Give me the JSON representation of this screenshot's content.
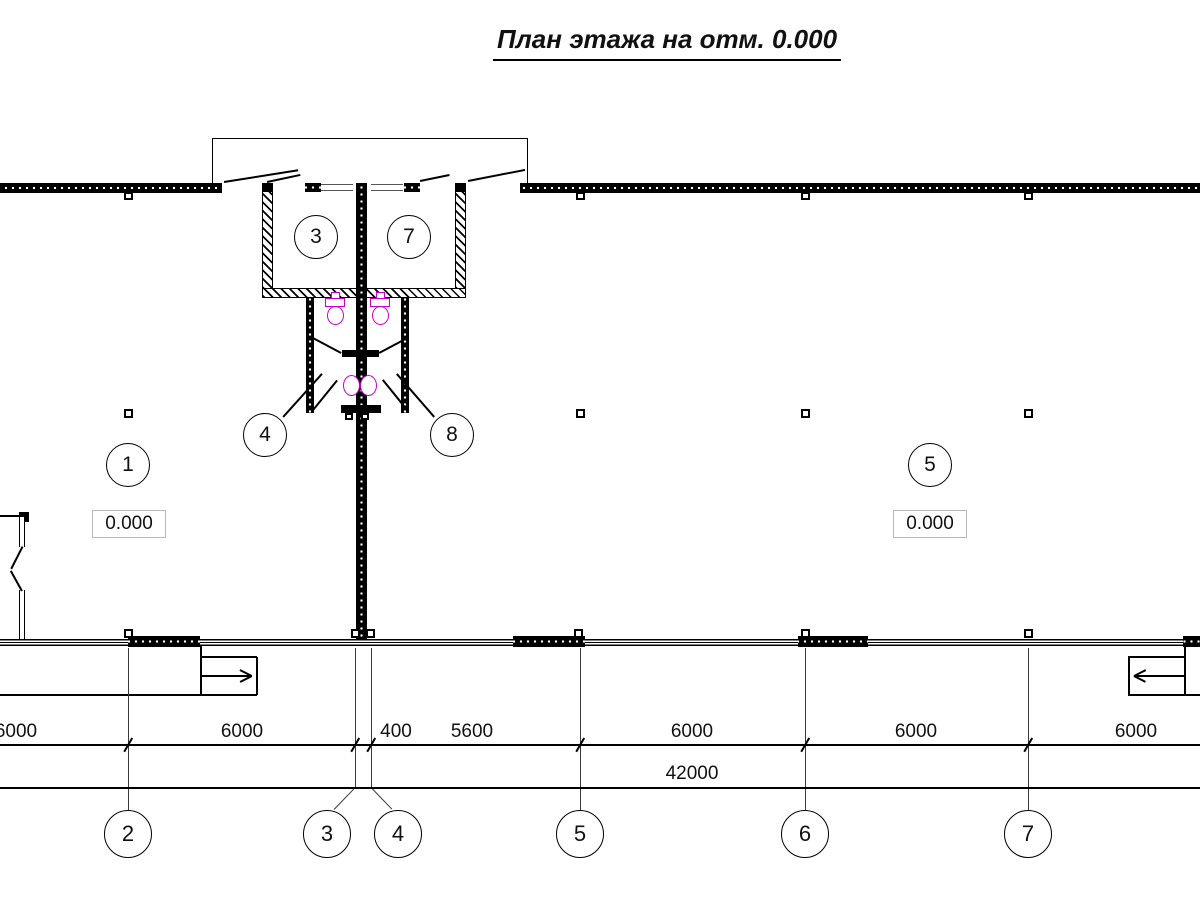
{
  "title": "План этажа на отм. 0.000",
  "colors": {
    "fixture_magenta": "#CC00CC",
    "line_black": "#000000"
  },
  "room_tags": {
    "hall_left": {
      "label": "1"
    },
    "hall_right": {
      "label": "5"
    },
    "wc_left": {
      "label": "3"
    },
    "wc_right": {
      "label": "7"
    },
    "lobby_left": {
      "label": "4"
    },
    "lobby_right": {
      "label": "8"
    }
  },
  "elevation_marks": {
    "left": "0.000",
    "right": "0.000"
  },
  "dimensions": {
    "row1": {
      "d0": "6000",
      "d1": "6000",
      "d2": "400",
      "d3": "5600",
      "d4": "6000",
      "d5": "6000",
      "d6": "6000"
    },
    "total": "42000"
  },
  "axes": {
    "a2": {
      "label": "2"
    },
    "a3": {
      "label": "3"
    },
    "a4": {
      "label": "4"
    },
    "a5": {
      "label": "5"
    },
    "a6": {
      "label": "6"
    },
    "a7": {
      "label": "7"
    }
  }
}
